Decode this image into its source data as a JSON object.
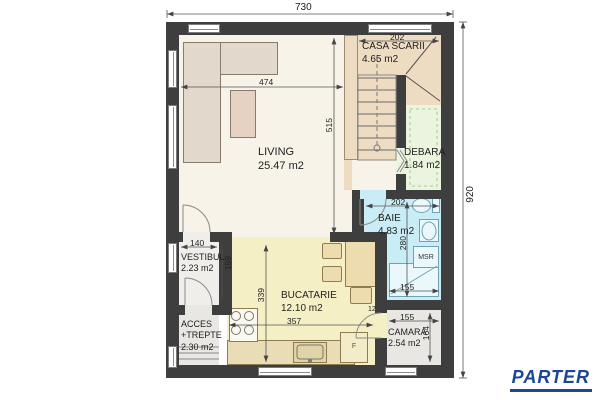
{
  "plan": {
    "title": "PARTER"
  },
  "rooms": {
    "living": {
      "name": "LIVING",
      "area": "25.47 m2"
    },
    "casa_scarii": {
      "name": "CASA SCARII",
      "area": "4.65 m2"
    },
    "debara": {
      "name": "DEBARA",
      "area": "1.84 m2"
    },
    "baie": {
      "name": "BAIE",
      "area": "4.83 m2"
    },
    "vestibul": {
      "name": "VESTIBUL",
      "area": "2.23 m2"
    },
    "bucatarie": {
      "name": "BUCATARIE",
      "area": "12.10 m2"
    },
    "acces": {
      "name_line1": "ACCES",
      "name_line2": "+TREPTE",
      "area": "2.30 m2"
    },
    "camara": {
      "name": "CAMARA",
      "area": "2.54 m2"
    }
  },
  "fixtures": {
    "washing_machine": "MSR",
    "fridge": "F"
  },
  "dimensions": {
    "overall_width": "730",
    "overall_height": "920",
    "casa_scarii_width": "202",
    "living_width": "474",
    "living_height": "515",
    "vestibul_width": "140",
    "vestibul_height": "159",
    "bucatarie_height": "339",
    "bucatarie_width": "357",
    "baie_width": "202",
    "baie_height": "280",
    "baie_bottom": "155",
    "camara_width": "155",
    "camara_height": "164",
    "door_width": "12"
  },
  "colors": {
    "wall": "#3e3e3e",
    "living_floor": "#f8f3e9",
    "stair_floor": "#eddcc2",
    "debara_floor": "#ebf4df",
    "baie_floor": "#c9edf6",
    "kitchen_floor": "#f5efc6",
    "vestibul_floor": "#f0eeea",
    "service_floor": "#e9e7e3",
    "accent": "#1c4697"
  }
}
